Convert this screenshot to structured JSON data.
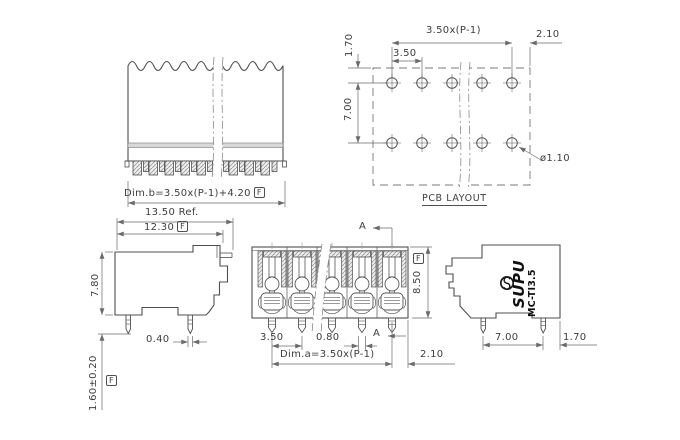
{
  "colors": {
    "line": "#4f4f4f",
    "dim": "#6a6a6a",
    "text": "#3d3d3d",
    "band_fill": "#d9d9d9"
  },
  "frame_symbol": "F",
  "top_front_view": {
    "dim_b": "Dim.b=3.50x(P-1)+4.20"
  },
  "pcb_layout": {
    "title": "PCB LAYOUT",
    "total_pitch": "3.50x(P-1)",
    "pitch": "3.50",
    "edge_offset": "2.10",
    "row_top_offset": "1.70",
    "row_spacing": "7.00",
    "hole_diameter": "ø1.10"
  },
  "left_side_view": {
    "ref_width": "13.50 Ref.",
    "width": "12.30",
    "height": "7.80",
    "pin_width": "0.40",
    "pin_length": "1.60±0.20"
  },
  "front_section_view": {
    "section_label": "A",
    "height": "8.50",
    "pitch": "3.50",
    "pin_width": "0.80",
    "dim_a": "Dim.a=3.50x(P-1)",
    "edge_offset": "2.10"
  },
  "right_side_view": {
    "brand": "SUPU",
    "model": "MC-TI3.5",
    "pin_spacing": "7.00",
    "edge_offset": "1.70"
  }
}
